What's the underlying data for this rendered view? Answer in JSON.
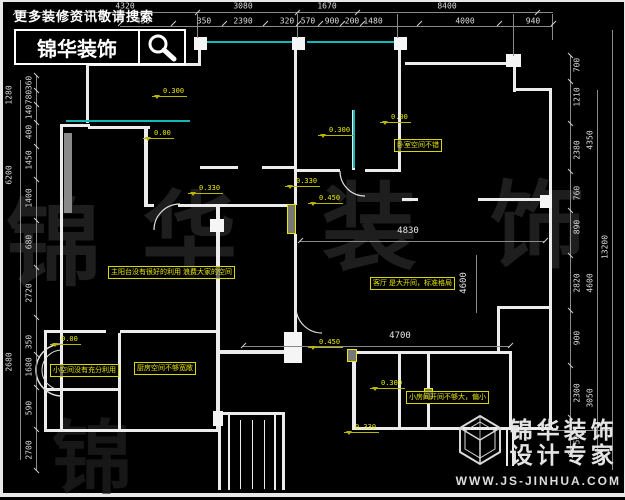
{
  "header": {
    "search_hint": "更多装修资讯敬请搜索",
    "brand": "锦华装饰",
    "search_icon": "magnifier-icon"
  },
  "footer": {
    "brand": "锦华装饰",
    "tagline": "设计专家",
    "website": "WWW.JS-JINHUA.COM",
    "logo_icon": "hexagon-cube-logo"
  },
  "watermark": {
    "chars": [
      "锦",
      "华",
      "装",
      "饰"
    ]
  },
  "colors": {
    "background": "#000000",
    "wall": "#ececec",
    "window": "#12b8b8",
    "annotation": "#e8e800",
    "dimension_text": "#dcdcdc",
    "watermark": "#1e1e1e"
  },
  "dimensions": {
    "top_row1": [
      {
        "label": "4320",
        "x": 125
      },
      {
        "label": "3080",
        "x": 243
      },
      {
        "label": "1670",
        "x": 327
      },
      {
        "label": "8400",
        "x": 447
      }
    ],
    "top_row2": [
      {
        "label": "450",
        "x": 143
      },
      {
        "label": "350",
        "x": 204
      },
      {
        "label": "2390",
        "x": 243
      },
      {
        "label": "320",
        "x": 287
      },
      {
        "label": "570",
        "x": 308
      },
      {
        "label": "900",
        "x": 332
      },
      {
        "label": "200",
        "x": 352
      },
      {
        "label": "1480",
        "x": 373
      },
      {
        "label": "4000",
        "x": 465
      },
      {
        "label": "940",
        "x": 533
      }
    ],
    "left_inner": [
      {
        "label": "360",
        "y": 83
      },
      {
        "label": "780",
        "y": 97
      },
      {
        "label": "140",
        "y": 112
      },
      {
        "label": "400",
        "y": 132
      },
      {
        "label": "1450",
        "y": 160
      },
      {
        "label": "1400",
        "y": 198
      },
      {
        "label": "680",
        "y": 242
      },
      {
        "label": "2720",
        "y": 293
      },
      {
        "label": "350",
        "y": 342
      },
      {
        "label": "1680",
        "y": 367
      },
      {
        "label": "590",
        "y": 408
      },
      {
        "label": "2700",
        "y": 450
      }
    ],
    "left_outer": [
      {
        "label": "1280",
        "y": 95
      },
      {
        "label": "6200",
        "y": 175
      },
      {
        "label": "2680",
        "y": 362
      }
    ],
    "right_main": [
      {
        "label": "700",
        "y": 65
      },
      {
        "label": "1210",
        "y": 97
      },
      {
        "label": "2380",
        "y": 150
      },
      {
        "label": "760",
        "y": 193
      },
      {
        "label": "890",
        "y": 227
      },
      {
        "label": "2820",
        "y": 283
      },
      {
        "label": "900",
        "y": 338
      },
      {
        "label": "2300",
        "y": 393
      },
      {
        "label": "750",
        "y": 442
      }
    ],
    "right_inner": [
      {
        "label": "4350",
        "y": 140
      },
      {
        "label": "4600",
        "y": 283
      },
      {
        "label": "3050",
        "y": 398
      }
    ],
    "right_outer": [
      {
        "label": "13200",
        "y": 247
      }
    ],
    "interior": [
      {
        "label": "4830",
        "x": 408,
        "y": 231
      },
      {
        "label": "4700",
        "x": 400,
        "y": 336
      },
      {
        "label": "4600",
        "x": 464,
        "y": 283,
        "rot": true
      }
    ]
  },
  "levels": [
    {
      "label": "0.300",
      "x": 152,
      "y": 87
    },
    {
      "label": "0.00",
      "x": 143,
      "y": 129
    },
    {
      "label": "0.300",
      "x": 318,
      "y": 126
    },
    {
      "label": "0.00",
      "x": 380,
      "y": 113
    },
    {
      "label": "0.330",
      "x": 188,
      "y": 184
    },
    {
      "label": "0.330",
      "x": 285,
      "y": 177
    },
    {
      "label": "0.450",
      "x": 308,
      "y": 194
    },
    {
      "label": "0.450",
      "x": 308,
      "y": 338
    },
    {
      "label": "0.300",
      "x": 370,
      "y": 379
    },
    {
      "label": "0.330",
      "x": 344,
      "y": 423
    },
    {
      "label": "0.00",
      "x": 50,
      "y": 335
    }
  ],
  "notes": [
    {
      "text": "主阳台没有很好的利用  浪费大家的空间",
      "x": 108,
      "y": 266
    },
    {
      "text": "客厅 是大开间，标准格局",
      "x": 370,
      "y": 277
    },
    {
      "text": "卧室空间不错",
      "x": 394,
      "y": 139
    },
    {
      "text": "小空间没有充分利用",
      "x": 50,
      "y": 364
    },
    {
      "text": "厨房空间不够宽敞",
      "x": 134,
      "y": 362
    },
    {
      "text": "小房间开间不够大，偏小",
      "x": 406,
      "y": 391
    }
  ]
}
